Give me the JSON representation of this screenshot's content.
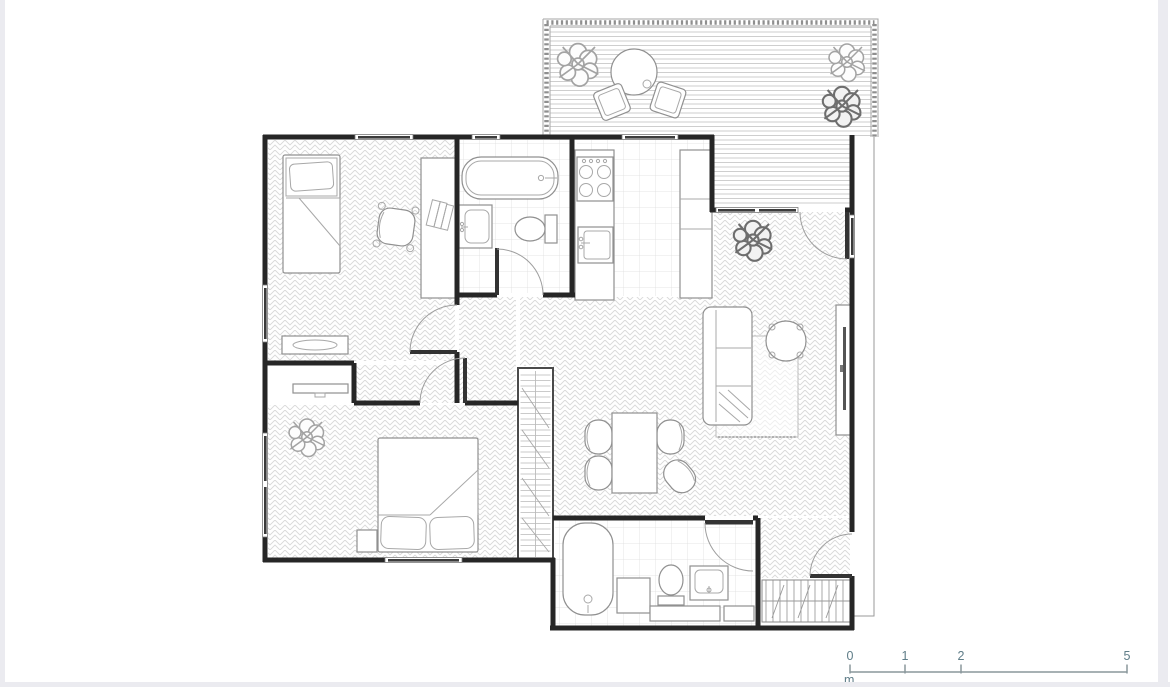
{
  "page": {
    "background": "#ffffff",
    "edge_strip_color": "#ebebf0"
  },
  "floor_plan": {
    "wall_color": "#262626",
    "furniture_line_color": "#909090",
    "floor_pattern_color": "#d9d9d9",
    "tile_line_color": "#dedede",
    "deck_line_color": "#c9c9c9",
    "window_glass_color": "#3b3b3b",
    "symbols": [
      "terrace-table",
      "terrace-chair",
      "plant",
      "single-bed",
      "office-chair",
      "desk",
      "books",
      "console-table",
      "shelf-console",
      "double-bed",
      "nightstand",
      "wardrobe",
      "bathtub",
      "wall-sink",
      "toilet",
      "stove",
      "kitchen-sink",
      "kitchen-counter",
      "sofa",
      "round-armchair",
      "rug",
      "tv-sideboard",
      "dining-table",
      "dining-chair",
      "vanity-sink",
      "bathroom-cabinet",
      "doormat"
    ]
  },
  "scale_bar": {
    "labels": [
      "0",
      "1",
      "2",
      "5"
    ],
    "unit": "m",
    "text_color": "#5f7d88",
    "line_color": "#8a979c"
  }
}
